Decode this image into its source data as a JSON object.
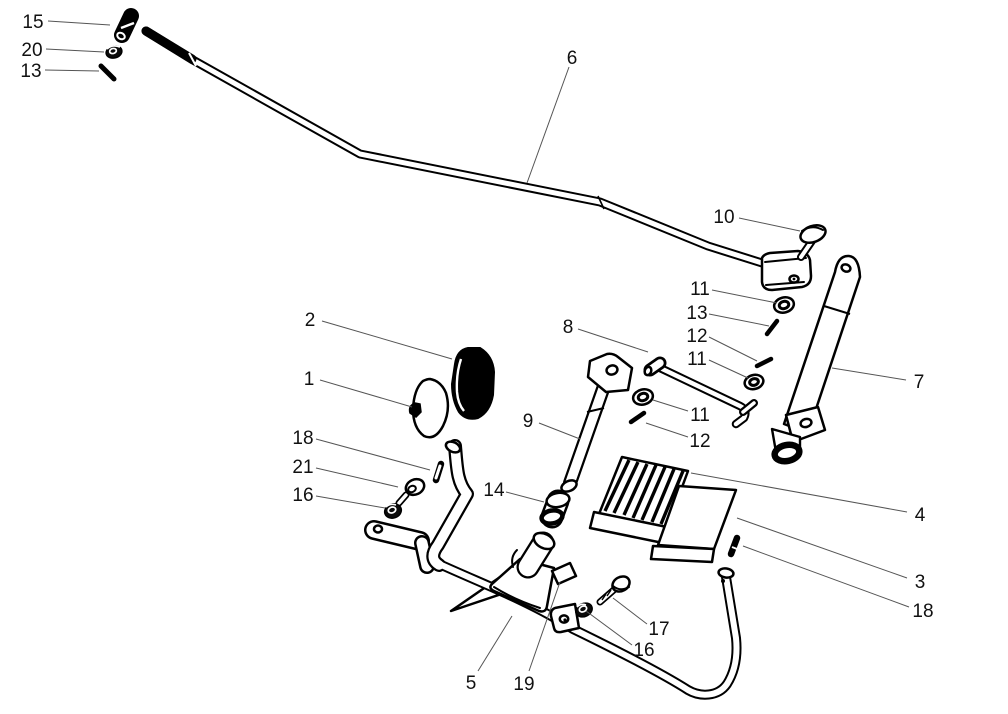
{
  "figure": {
    "type": "exploded-parts-diagram",
    "background": "#ffffff",
    "line_color": "#000000",
    "label_color": "#111111",
    "leader_color": "#555555",
    "label_font_size": 19
  },
  "callouts": [
    {
      "text": "15",
      "x": 33,
      "y": 21,
      "leader": {
        "x1": 48,
        "y1": 21,
        "x2": 110,
        "y2": 25
      }
    },
    {
      "text": "20",
      "x": 32,
      "y": 49,
      "leader": {
        "x1": 46,
        "y1": 49,
        "x2": 104,
        "y2": 52
      }
    },
    {
      "text": "13",
      "x": 31,
      "y": 70,
      "leader": {
        "x1": 45,
        "y1": 70,
        "x2": 99,
        "y2": 71
      }
    },
    {
      "text": "6",
      "x": 572,
      "y": 57,
      "leader": {
        "x1": 569,
        "y1": 67,
        "x2": 527,
        "y2": 183
      }
    },
    {
      "text": "10",
      "x": 724,
      "y": 216,
      "leader": {
        "x1": 739,
        "y1": 218,
        "x2": 800,
        "y2": 231
      }
    },
    {
      "text": "11",
      "x": 700,
      "y": 288,
      "leader": {
        "x1": 712,
        "y1": 290,
        "x2": 777,
        "y2": 303
      }
    },
    {
      "text": "13",
      "x": 697,
      "y": 312,
      "leader": {
        "x1": 709,
        "y1": 314,
        "x2": 769,
        "y2": 326
      }
    },
    {
      "text": "12",
      "x": 697,
      "y": 335,
      "leader": {
        "x1": 709,
        "y1": 337,
        "x2": 757,
        "y2": 361
      }
    },
    {
      "text": "11",
      "x": 697,
      "y": 358,
      "leader": {
        "x1": 709,
        "y1": 360,
        "x2": 748,
        "y2": 378
      }
    },
    {
      "text": "8",
      "x": 568,
      "y": 326,
      "leader": {
        "x1": 578,
        "y1": 329,
        "x2": 648,
        "y2": 352
      }
    },
    {
      "text": "7",
      "x": 919,
      "y": 381,
      "leader": {
        "x1": 906,
        "y1": 380,
        "x2": 832,
        "y2": 368
      }
    },
    {
      "text": "9",
      "x": 528,
      "y": 420,
      "leader": {
        "x1": 539,
        "y1": 423,
        "x2": 580,
        "y2": 439
      }
    },
    {
      "text": "2",
      "x": 310,
      "y": 319,
      "leader": {
        "x1": 322,
        "y1": 321,
        "x2": 452,
        "y2": 359
      }
    },
    {
      "text": "1",
      "x": 309,
      "y": 378,
      "leader": {
        "x1": 320,
        "y1": 380,
        "x2": 412,
        "y2": 407
      }
    },
    {
      "text": "18",
      "x": 303,
      "y": 437,
      "leader": {
        "x1": 316,
        "y1": 439,
        "x2": 430,
        "y2": 470
      }
    },
    {
      "text": "21",
      "x": 303,
      "y": 466,
      "leader": {
        "x1": 316,
        "y1": 468,
        "x2": 398,
        "y2": 487
      }
    },
    {
      "text": "16",
      "x": 303,
      "y": 494,
      "leader": {
        "x1": 316,
        "y1": 496,
        "x2": 385,
        "y2": 508
      }
    },
    {
      "text": "14",
      "x": 494,
      "y": 489,
      "leader": {
        "x1": 506,
        "y1": 492,
        "x2": 544,
        "y2": 502
      }
    },
    {
      "text": "11",
      "x": 700,
      "y": 414,
      "leader": {
        "x1": 688,
        "y1": 411,
        "x2": 653,
        "y2": 400
      }
    },
    {
      "text": "12",
      "x": 700,
      "y": 440,
      "leader": {
        "x1": 688,
        "y1": 437,
        "x2": 646,
        "y2": 423
      }
    },
    {
      "text": "4",
      "x": 920,
      "y": 514,
      "leader": {
        "x1": 907,
        "y1": 512,
        "x2": 691,
        "y2": 473
      }
    },
    {
      "text": "3",
      "x": 920,
      "y": 581,
      "leader": {
        "x1": 907,
        "y1": 578,
        "x2": 737,
        "y2": 518
      }
    },
    {
      "text": "18",
      "x": 923,
      "y": 610,
      "leader": {
        "x1": 909,
        "y1": 607,
        "x2": 743,
        "y2": 546
      }
    },
    {
      "text": "5",
      "x": 471,
      "y": 682,
      "leader": {
        "x1": 478,
        "y1": 671,
        "x2": 512,
        "y2": 616
      }
    },
    {
      "text": "19",
      "x": 524,
      "y": 683,
      "leader": {
        "x1": 529,
        "y1": 671,
        "x2": 560,
        "y2": 582
      }
    },
    {
      "text": "17",
      "x": 659,
      "y": 628,
      "leader": {
        "x1": 647,
        "y1": 624,
        "x2": 613,
        "y2": 598
      }
    },
    {
      "text": "16",
      "x": 644,
      "y": 649,
      "leader": {
        "x1": 632,
        "y1": 645,
        "x2": 586,
        "y2": 611
      }
    }
  ]
}
